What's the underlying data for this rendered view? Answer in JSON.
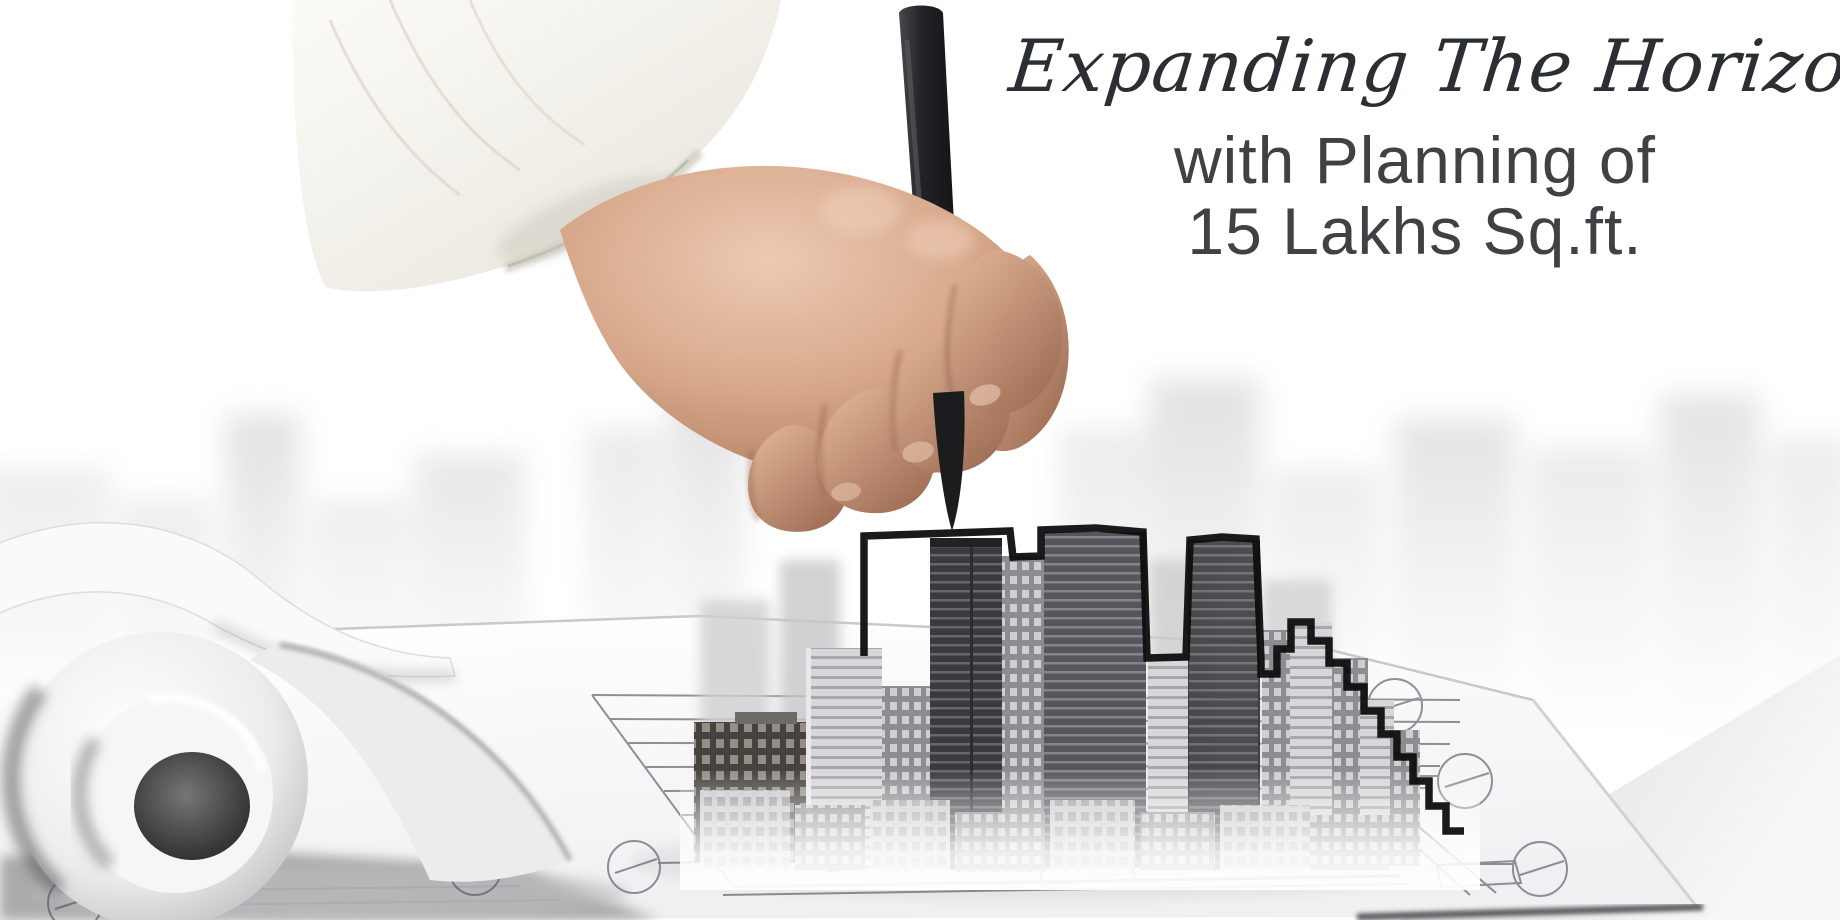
{
  "banner": {
    "headline_script": "Expanding The Horizon",
    "subheadline_line1": "with Planning of",
    "subheadline_line2": "15 Lakhs Sq.ft."
  },
  "colors": {
    "background": "#ffffff",
    "headline_script_text": "#2b2e33",
    "subheadline_text": "#404045",
    "city_outline": "#0e0e0e",
    "pen": "#1c1c1f",
    "blueprint_line": "#4a4a54",
    "skin_tone": "#d9ab8e",
    "sleeve": "#f6f4ee"
  },
  "scene": {
    "hand": "hand-holding-pen-photo",
    "pen": "black-pen",
    "sleeve": "white-shirt-sleeve",
    "city": "city-skyline-model",
    "blueprint": "architectural-blueprint-plan",
    "paper": "blueprint-paper-sheet",
    "page_curl": "rolled-page-curl",
    "background_city": "blurred-city-skyline"
  }
}
